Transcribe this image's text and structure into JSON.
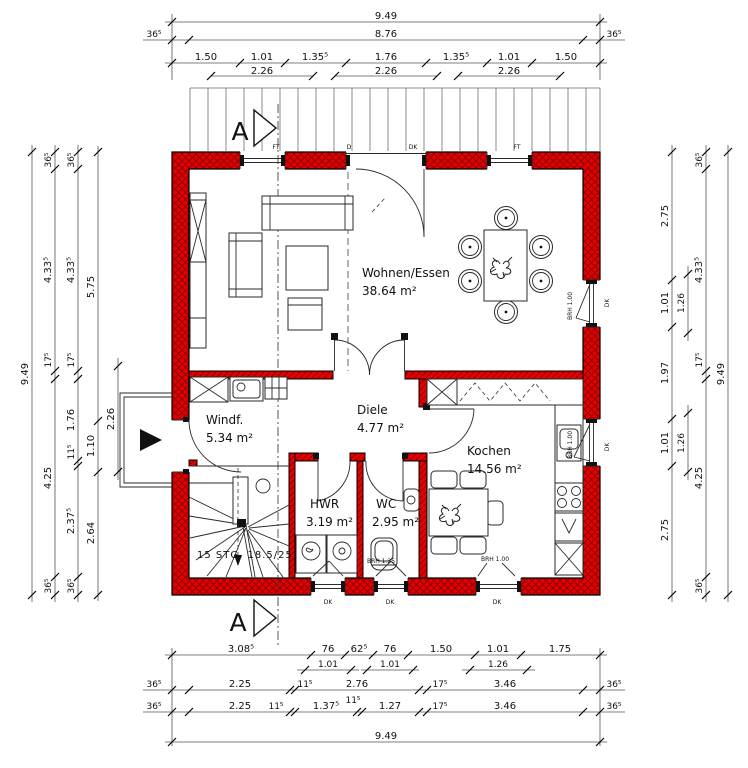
{
  "drawing": {
    "type": "floor-plan",
    "section_label": "A",
    "stairs_label": "15 STG. 18.5/25"
  },
  "rooms": {
    "wohnen": {
      "name": "Wohnen/Essen",
      "area": "38.64 m²"
    },
    "windfang": {
      "name": "Windf.",
      "area": "5.34 m²"
    },
    "diele": {
      "name": "Diele",
      "area": "4.77 m²"
    },
    "kochen": {
      "name": "Kochen",
      "area": "14.56 m²"
    },
    "hwr": {
      "name": "HWR",
      "area": "3.19 m²"
    },
    "wc": {
      "name": "WC",
      "area": "2.95 m²"
    }
  },
  "labels": {
    "ft": "FT",
    "d": "D",
    "dk": "DK",
    "brh_100": "BRH 1.00",
    "brh_125": "BRH 1.25"
  },
  "dims": {
    "top": {
      "overall": "9.49",
      "wall_left": "36⁵",
      "shell": "8.76",
      "wall_right": "36⁵",
      "segments": [
        "1.50",
        "1.01",
        "1.35⁵",
        "1.76",
        "1.35⁵",
        "1.01",
        "1.50"
      ],
      "openings": [
        "2.26",
        "2.26",
        "2.26"
      ]
    },
    "left": {
      "overall": "9.49",
      "chain_a": [
        "36⁵",
        "4.33⁵",
        "17⁵",
        "4.25",
        "36⁵"
      ],
      "chain_b": [
        "36⁵",
        "4.33⁵",
        "17⁵",
        "1.76",
        "11⁵",
        "2.37⁵",
        "36⁵"
      ],
      "chain_c": [
        "5.75",
        "1.10",
        "2.64"
      ],
      "porch": "2.26"
    },
    "right": {
      "chain_a": [
        "2.75",
        "1.01",
        "1.97",
        "1.01",
        "2.75"
      ],
      "openings": [
        "1.26",
        "1.26"
      ],
      "chain_b": [
        "36⁵",
        "4.33⁵",
        "17⁵",
        "4.25",
        "36⁵"
      ],
      "overall": "9.49"
    },
    "bottom": {
      "row1": [
        "3.08⁵",
        "76",
        "62⁵",
        "76",
        "1.50",
        "1.01",
        "1.75"
      ],
      "row1_sub": [
        "1.01",
        "1.01",
        "1.26"
      ],
      "row2": [
        "36⁵",
        "2.25",
        "11⁵",
        "2.76",
        "17⁵",
        "3.46",
        "36⁵"
      ],
      "row2_sub": "11⁵",
      "row3": [
        "36⁵",
        "2.25",
        "11⁵",
        "1.37⁵",
        "1.27",
        "17⁵",
        "3.46",
        "36⁵"
      ],
      "overall": "9.49"
    }
  },
  "colors": {
    "wall_red": "#e30000",
    "hatch_dark": "#8f0000",
    "line": "#111111"
  }
}
